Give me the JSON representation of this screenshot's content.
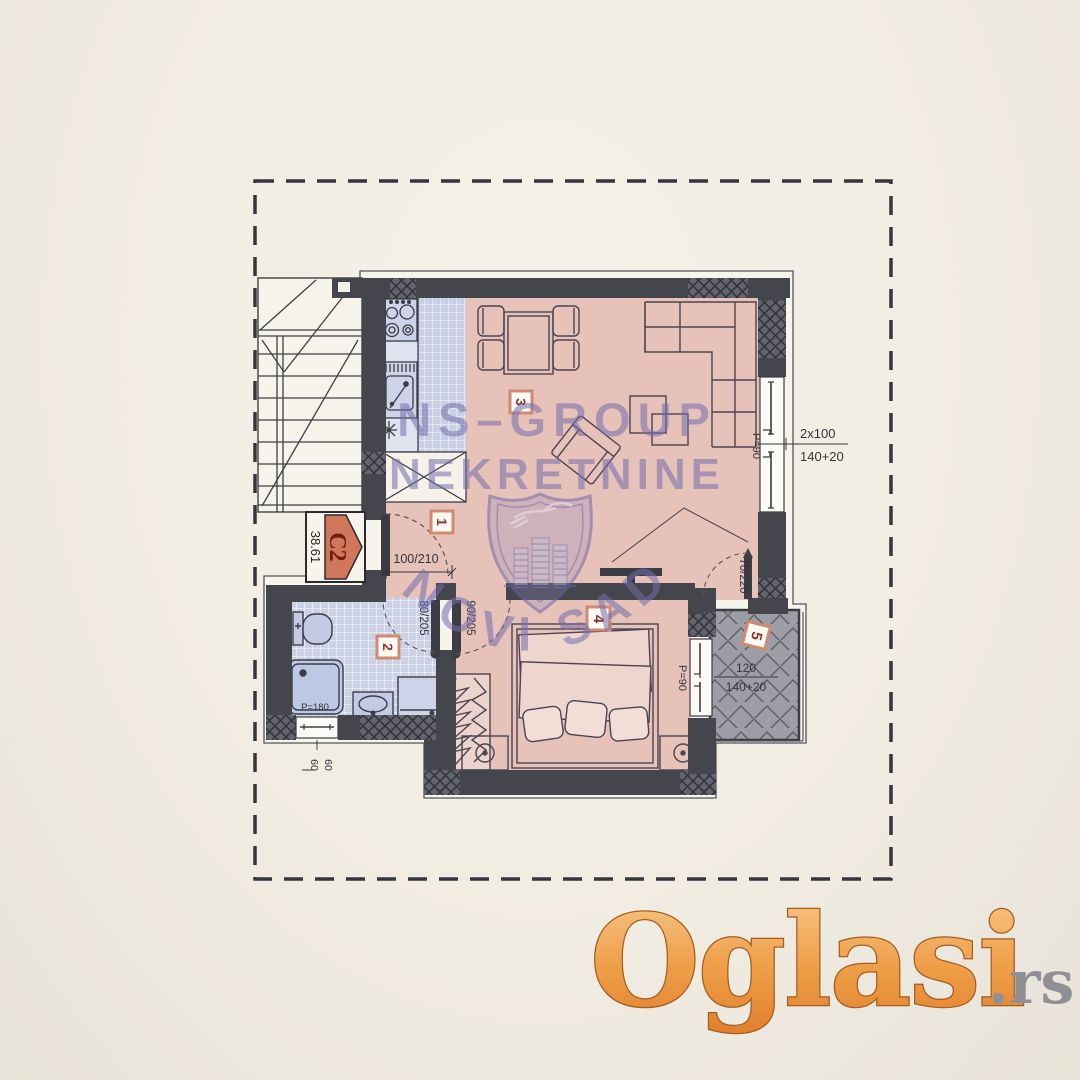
{
  "unit_badge": {
    "code": "C2",
    "area": "38.61"
  },
  "room_numbers": {
    "hall": "1",
    "bathroom": "2",
    "living": "3",
    "bedroom": "4",
    "terrace": "5"
  },
  "dimensions": {
    "entrance_door": "100/210",
    "bathroom_door": "80/205",
    "bedroom_door": "90/205",
    "terrace_door": "70/220",
    "living_window_count": "2x100",
    "living_window_height": "140+20",
    "living_window_parapet": "P=90",
    "bedroom_window_parapet": "P=90",
    "shower": "P=180",
    "terrace_window_width": "120",
    "terrace_window_height": "140+20",
    "bath_window_width": "60",
    "bath_window_height": "60"
  },
  "watermark": {
    "line1": "NS–GROUP",
    "line2": "NEKRETNINE",
    "arc_text": "NOVI SAD"
  },
  "logo": {
    "brand": "Oglasi",
    "tld": ".rs"
  },
  "colors": {
    "floor": "#e6c2b9",
    "tile": "#c9cfe4",
    "wall": "#45454d",
    "terrace": "#9d9da6",
    "watermark": "#746dac",
    "badge_border": "#cf8a72",
    "badge_text": "#8c3528",
    "unit_fill": "#d0765a",
    "logo_orange": "#ef9c4b",
    "logo_gray": "#8f9095"
  }
}
